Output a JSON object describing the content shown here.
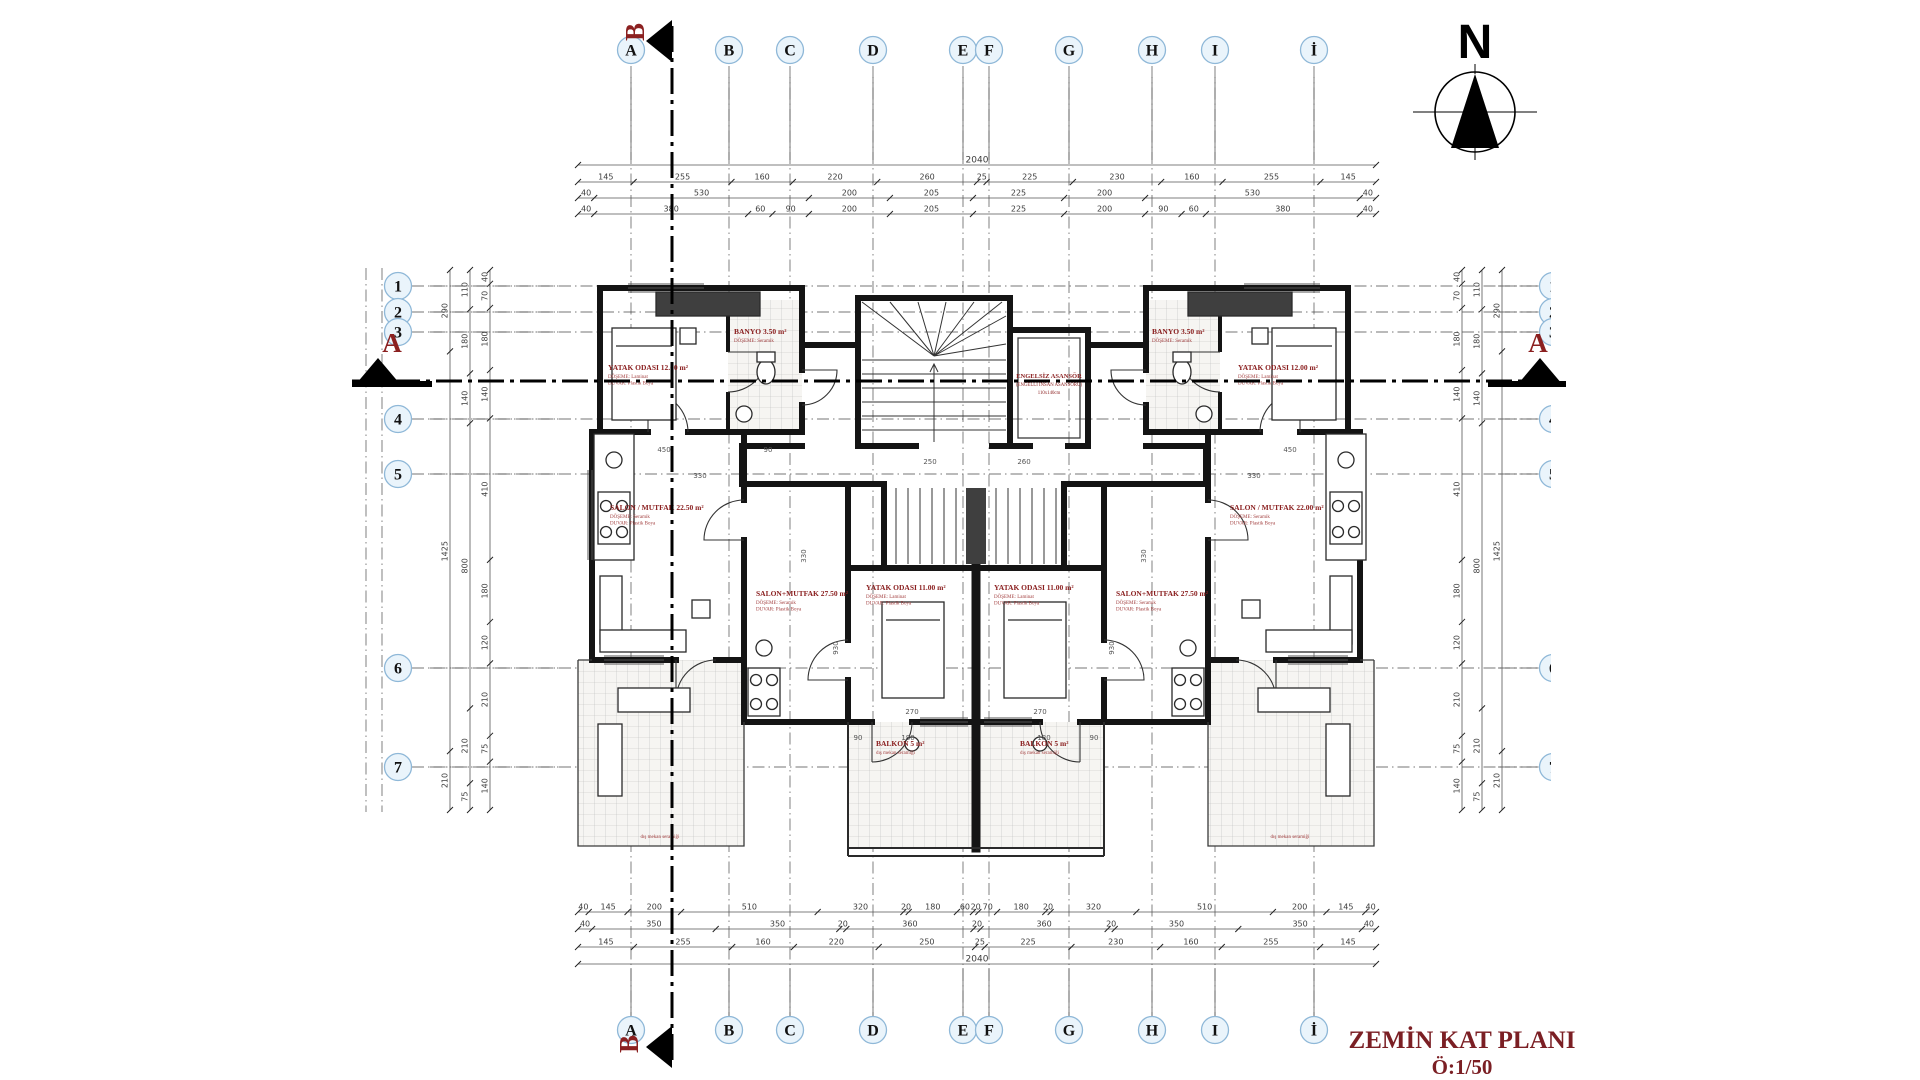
{
  "title": {
    "line1": "ZEMİN KAT PLANI",
    "line2": "Ö:1/50"
  },
  "north": {
    "label": "N"
  },
  "sections": {
    "a_label": "A",
    "b_label": "B"
  },
  "colors": {
    "red": "#8B2020",
    "red_dark": "#7B1F24",
    "bubble_fill": "#EAF4FB",
    "bubble_stroke": "#8FB8D8",
    "wall": "#141414",
    "dim": "#3C3C3C"
  },
  "grid": {
    "top_letters": [
      {
        "label": "A",
        "x": 631
      },
      {
        "label": "B",
        "x": 729
      },
      {
        "label": "C",
        "x": 790
      },
      {
        "label": "D",
        "x": 873
      },
      {
        "label": "E",
        "x": 963
      },
      {
        "label": "F",
        "x": 989
      },
      {
        "label": "G",
        "x": 1069
      },
      {
        "label": "H",
        "x": 1152
      },
      {
        "label": "I",
        "x": 1215
      },
      {
        "label": "İ",
        "x": 1314
      }
    ],
    "bottom_letters": [
      {
        "label": "A",
        "x": 631
      },
      {
        "label": "B",
        "x": 729
      },
      {
        "label": "C",
        "x": 790
      },
      {
        "label": "D",
        "x": 873
      },
      {
        "label": "E",
        "x": 963
      },
      {
        "label": "F",
        "x": 989
      },
      {
        "label": "G",
        "x": 1069
      },
      {
        "label": "H",
        "x": 1152
      },
      {
        "label": "I",
        "x": 1215
      },
      {
        "label": "İ",
        "x": 1314
      }
    ],
    "left_numbers": [
      {
        "label": "1",
        "y": 286
      },
      {
        "label": "2",
        "y": 312
      },
      {
        "label": "3",
        "y": 332
      },
      {
        "label": "4",
        "y": 419
      },
      {
        "label": "5",
        "y": 474
      },
      {
        "label": "6",
        "y": 668
      },
      {
        "label": "7",
        "y": 767
      }
    ],
    "right_numbers": [
      {
        "label": "1",
        "y": 286
      },
      {
        "label": "2",
        "y": 312
      },
      {
        "label": "3",
        "y": 332
      },
      {
        "label": "4",
        "y": 419
      },
      {
        "label": "5",
        "y": 474
      },
      {
        "label": "6",
        "y": 668
      },
      {
        "label": "7",
        "y": 767
      }
    ]
  },
  "dim_chains": {
    "top": [
      {
        "y": 165,
        "total": "2040"
      },
      {
        "y": 182,
        "values": [
          "145",
          "255",
          "160",
          "220",
          "260",
          "25",
          "225",
          "230",
          "160",
          "255",
          "145"
        ]
      },
      {
        "y": 198,
        "values": [
          "40",
          "530",
          "200",
          "205",
          "225",
          "200",
          "530",
          "40"
        ]
      },
      {
        "y": 214,
        "values": [
          "40",
          "380",
          "60",
          "90",
          "200",
          "205",
          "225",
          "200",
          "90",
          "60",
          "380",
          "40"
        ]
      }
    ],
    "bottom": [
      {
        "y": 912,
        "values": [
          "40",
          "145",
          "200",
          "510",
          "320",
          "20",
          "180",
          "60",
          "20",
          "70",
          "180",
          "20",
          "320",
          "510",
          "200",
          "145",
          "40"
        ]
      },
      {
        "y": 929,
        "values": [
          "40",
          "350",
          "350",
          "20",
          "360",
          "20",
          "360",
          "20",
          "350",
          "350",
          "40"
        ]
      },
      {
        "y": 947,
        "values": [
          "145",
          "255",
          "160",
          "220",
          "250",
          "25",
          "225",
          "230",
          "160",
          "255",
          "145"
        ]
      },
      {
        "y": 964,
        "total": "2040"
      }
    ],
    "left": [
      {
        "x": 450,
        "values": [
          "290",
          "1425",
          "210"
        ]
      },
      {
        "x": 470,
        "values": [
          "110",
          "180",
          "140",
          "800",
          "210",
          "75"
        ]
      },
      {
        "x": 490,
        "values": [
          "40",
          "70",
          "180",
          "140",
          "410",
          "180",
          "120",
          "210",
          "75",
          "140"
        ]
      }
    ],
    "right": [
      {
        "x": 1502,
        "values": [
          "290",
          "1425",
          "210"
        ]
      },
      {
        "x": 1482,
        "values": [
          "110",
          "180",
          "140",
          "800",
          "210",
          "75"
        ]
      },
      {
        "x": 1462,
        "values": [
          "40",
          "70",
          "180",
          "140",
          "410",
          "180",
          "120",
          "210",
          "75",
          "140"
        ]
      }
    ]
  },
  "rooms": [
    {
      "x": 608,
      "y": 370,
      "title": "YATAK ODASI 12.00 m²",
      "subs": [
        "DÖŞEME: Laminat",
        "DUVAR: Plastik Boya"
      ]
    },
    {
      "x": 1238,
      "y": 370,
      "title": "YATAK ODASI 12.00 m²",
      "subs": [
        "DÖŞEME: Laminat",
        "DUVAR: Plastik Boya"
      ]
    },
    {
      "x": 734,
      "y": 334,
      "title": "BANYO 3.50 m²",
      "subs": [
        "DÖŞEME: Seramik"
      ]
    },
    {
      "x": 1152,
      "y": 334,
      "title": "BANYO 3.50 m²",
      "subs": [
        "DÖŞEME: Seramik"
      ]
    },
    {
      "x": 610,
      "y": 510,
      "title": "SALON / MUTFAK 22.50 m²",
      "subs": [
        "DÖŞEME: Seramik",
        "DUVAR: Plastik Boya"
      ]
    },
    {
      "x": 1230,
      "y": 510,
      "title": "SALON / MUTFAK 22.00 m²",
      "subs": [
        "DÖŞEME: Seramik",
        "DUVAR: Plastik Boya"
      ]
    },
    {
      "x": 756,
      "y": 596,
      "title": "SALON+MUTFAK 27.50 m²",
      "subs": [
        "DÖŞEME: Seramik",
        "DUVAR: Plastik Boya"
      ]
    },
    {
      "x": 1116,
      "y": 596,
      "title": "SALON+MUTFAK 27.50 m²",
      "subs": [
        "DÖŞEME: Seramik",
        "DUVAR: Plastik Boya"
      ]
    },
    {
      "x": 866,
      "y": 590,
      "title": "YATAK ODASI 11.00 m²",
      "subs": [
        "DÖŞEME: Laminat",
        "DUVAR: Plastik Boya"
      ]
    },
    {
      "x": 994,
      "y": 590,
      "title": "YATAK ODASI 11.00 m²",
      "subs": [
        "DÖŞEME: Laminat",
        "DUVAR: Plastik Boya"
      ]
    },
    {
      "x": 876,
      "y": 746,
      "title": "BALKON 5 m²",
      "subs": [
        "dış mekan seramiği"
      ]
    },
    {
      "x": 1020,
      "y": 746,
      "title": "BALKON 5 m²",
      "subs": [
        "dış mekan seramiği"
      ]
    }
  ],
  "elevator": {
    "x": 1049,
    "y": 378,
    "lines": [
      "ENGELSİZ ASANSÖR",
      "(ENGELLİ İNSAN ASANSÖRÜ)",
      "110x140cm"
    ]
  },
  "interior_dims": [
    {
      "t": "450",
      "x": 664,
      "y": 452
    },
    {
      "t": "330",
      "x": 700,
      "y": 478
    },
    {
      "t": "90",
      "x": 768,
      "y": 452
    },
    {
      "t": "250",
      "x": 930,
      "y": 464
    },
    {
      "t": "260",
      "x": 1024,
      "y": 464
    },
    {
      "t": "330",
      "x": 1254,
      "y": 478
    },
    {
      "t": "450",
      "x": 1290,
      "y": 452
    },
    {
      "t": "930",
      "x": 838,
      "y": 648,
      "rot": true
    },
    {
      "t": "930",
      "x": 1114,
      "y": 648,
      "rot": true
    },
    {
      "t": "270",
      "x": 912,
      "y": 714
    },
    {
      "t": "270",
      "x": 1040,
      "y": 714
    },
    {
      "t": "180",
      "x": 908,
      "y": 740
    },
    {
      "t": "180",
      "x": 1044,
      "y": 740
    },
    {
      "t": "90",
      "x": 858,
      "y": 740
    },
    {
      "t": "90",
      "x": 1094,
      "y": 740
    },
    {
      "t": "330",
      "x": 806,
      "y": 556,
      "rot": true
    },
    {
      "t": "330",
      "x": 1146,
      "y": 556,
      "rot": true
    }
  ],
  "footer_notes": [
    {
      "x": 660,
      "y": 838,
      "t": "dış mekan seramiği"
    },
    {
      "x": 1290,
      "y": 838,
      "t": "dış mekan seramiği"
    }
  ]
}
